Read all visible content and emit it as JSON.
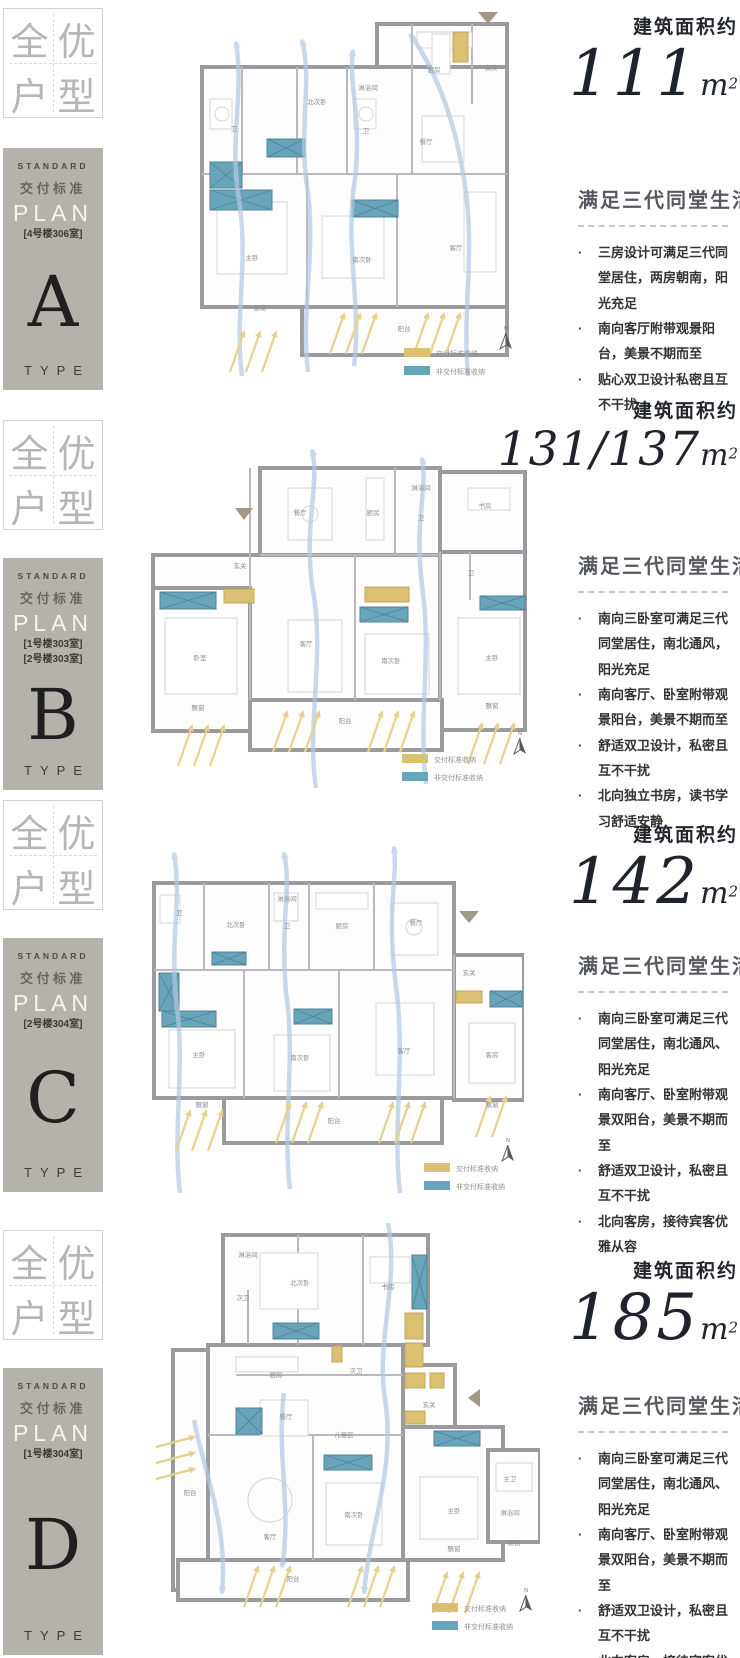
{
  "legend": {
    "delivered": "交付标准收纳",
    "undelivered": "非交付标准收纳"
  },
  "compass_label": "N",
  "badge_chars": [
    "全",
    "优",
    "户",
    "型"
  ],
  "plan_box_common": {
    "standard": "STANDARD",
    "delivery_std": "交付标准",
    "plan": "PLAN",
    "type": "TYPE"
  },
  "colors": {
    "teal": "#69a5ba",
    "yellow": "#dcc072",
    "wall": "#9b9b9f",
    "flow": "#b3c9e0",
    "sun": "#e6d28c",
    "plan_box_bg": "#b5b2ab"
  },
  "sections": [
    {
      "letter": "A",
      "units": [
        "[4号楼306室]"
      ],
      "area_label": "建筑面积约",
      "area_value": "111",
      "area_unit": "m",
      "area_sup": "2",
      "features_title": "满足三代同堂生活",
      "bullets": [
        "三房设计可满足三代同堂居住，两房朝南，阳光充足",
        "南向客厅附带观景阳台，美景不期而至",
        "贴心双卫设计私密且互不干扰"
      ],
      "rooms": [
        "卫",
        "北次卧",
        "淋浴间",
        "卫",
        "厨房",
        "玄关",
        "餐厅",
        "主卧",
        "南次卧",
        "客厅",
        "阳台",
        "飘窗"
      ]
    },
    {
      "letter": "B",
      "units": [
        "[1号楼303室]",
        "[2号楼303室]"
      ],
      "area_label": "建筑面积约",
      "area_value": "131/137",
      "area_unit": "m",
      "area_sup": "2",
      "features_title": "满足三代同堂生活",
      "bullets": [
        "南向三卧室可满足三代同堂居住，南北通风，阳光充足",
        "南向客厅、卧室附带观景阳台，美景不期而至",
        "舒适双卫设计，私密且互不干扰",
        "北向独立书房，读书学习舒适安静"
      ],
      "rooms": [
        "餐厅",
        "厨房",
        "淋浴间",
        "卫",
        "书房",
        "玄关",
        "卧室",
        "客厅",
        "南次卧",
        "主卧",
        "卫",
        "阳台",
        "飘窗",
        "飘窗"
      ]
    },
    {
      "letter": "C",
      "units": [
        "[2号楼304室]"
      ],
      "area_label": "建筑面积约",
      "area_value": "142",
      "area_unit": "m",
      "area_sup": "2",
      "features_title": "满足三代同堂生活",
      "bullets": [
        "南向三卧室可满足三代同堂居住，南北通风、阳光充足",
        "南向客厅、卧室附带观景双阳台，美景不期而至",
        "舒适双卫设计，私密且互不干扰",
        "北向客房，接待宾客优雅从容"
      ],
      "rooms": [
        "卫",
        "北次卧",
        "淋浴间",
        "卫",
        "厨房",
        "餐厅",
        "玄关",
        "主卧",
        "南次卧",
        "客厅",
        "客房",
        "阳台",
        "飘窗",
        "飘窗"
      ]
    },
    {
      "letter": "D",
      "units": [
        "[1号楼304室]"
      ],
      "area_label": "建筑面积约",
      "area_value": "185",
      "area_unit": "m",
      "area_sup": "2",
      "features_title": "满足三代同堂生活",
      "bullets": [
        "南向三卧室可满足三代同堂居住，南北通风、阳光充足",
        "南向客厅、卧室附带观景双阳台，美景不期而至",
        "舒适双卫设计，私密且互不干扰",
        "北向客房，接待宾客优雅从容"
      ],
      "rooms": [
        "淋浴间",
        "次卫",
        "北次卧",
        "书房",
        "厨房",
        "次卫",
        "玄关",
        "餐厅",
        "儿童区",
        "客厅",
        "阳台",
        "南次卧",
        "主卧",
        "主卫",
        "淋浴间",
        "阳台",
        "飘窗",
        "飘窗"
      ]
    }
  ]
}
